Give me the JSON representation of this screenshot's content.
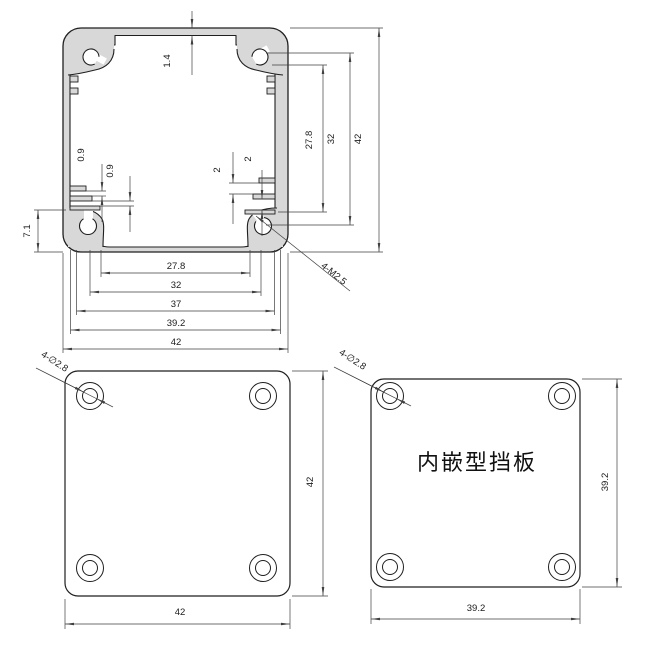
{
  "drawing": {
    "background": "#ffffff",
    "colors": {
      "metal_fill": "#d8d8d8",
      "outline": "#1f1f1f",
      "dim_line": "#3f3f3f"
    },
    "profile_view": {
      "wall_thickness": "1.4",
      "right_dims": {
        "inner": "27.8",
        "middle": "32",
        "outer": "42"
      },
      "left_bottom_height": "7.1",
      "left_slot_gaps": [
        "0.9",
        "0.9"
      ],
      "right_slot_gaps": [
        "2",
        "2"
      ],
      "bottom_widths": [
        "27.8",
        "32",
        "37",
        "39.2",
        "42"
      ],
      "corner_thread_callout": "4-M2.5"
    },
    "end_plate_view": {
      "hole_callout": "4-∅2.8",
      "height": "42",
      "width": "42"
    },
    "inset_plate_view": {
      "label": "内嵌型挡板",
      "hole_callout": "4-∅2.8",
      "height": "39.2",
      "width": "39.2"
    }
  }
}
